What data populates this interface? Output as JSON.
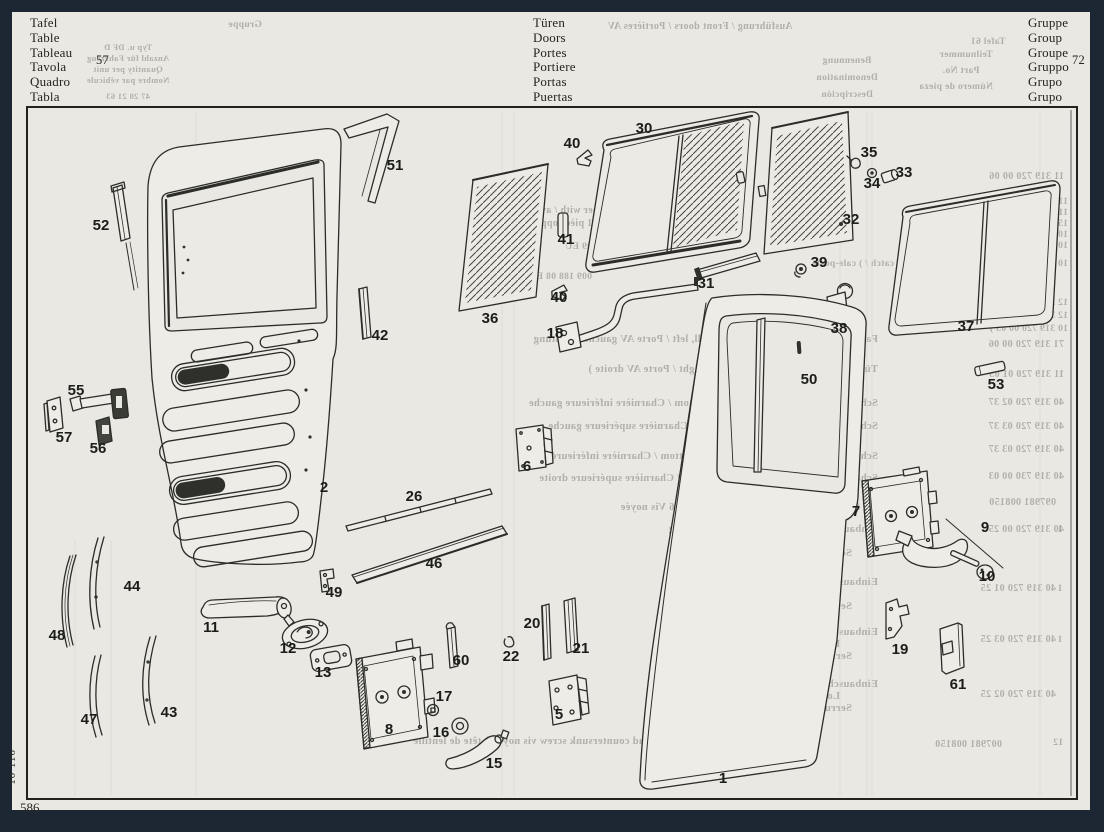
{
  "page": {
    "background": "#e9e8e3",
    "frame_color": "#1d2734"
  },
  "header": {
    "table_block": {
      "lines": [
        "Tafel",
        "Table",
        "Tableau",
        "Tavola",
        "Quadro",
        "Tabla"
      ],
      "number": "57"
    },
    "title_block": {
      "lines": [
        "Türen",
        "Doors",
        "Portes",
        "Portiere",
        "Portas",
        "Puertas"
      ]
    },
    "group_block": {
      "lines": [
        "Gruppe",
        "Group",
        "Groupe",
        "Gruppo",
        "Grupo",
        "Grupo"
      ],
      "number": "72"
    }
  },
  "footer": {
    "plate_number": "586",
    "margin_code": "10 116"
  },
  "diagram": {
    "part_labels": [
      {
        "t": "1",
        "x": 723,
        "y": 783
      },
      {
        "t": "2",
        "x": 324,
        "y": 492
      },
      {
        "t": "5",
        "x": 559,
        "y": 719
      },
      {
        "t": "6",
        "x": 527,
        "y": 471
      },
      {
        "t": "7",
        "x": 856,
        "y": 516
      },
      {
        "t": "8",
        "x": 389,
        "y": 734
      },
      {
        "t": "9",
        "x": 985,
        "y": 532
      },
      {
        "t": "10",
        "x": 987,
        "y": 581
      },
      {
        "t": "11",
        "x": 211,
        "y": 632
      },
      {
        "t": "12",
        "x": 288,
        "y": 653
      },
      {
        "t": "13",
        "x": 323,
        "y": 677
      },
      {
        "t": "15",
        "x": 494,
        "y": 768
      },
      {
        "t": "16",
        "x": 441,
        "y": 737
      },
      {
        "t": "17",
        "x": 444,
        "y": 701
      },
      {
        "t": "18",
        "x": 555,
        "y": 338
      },
      {
        "t": "19",
        "x": 900,
        "y": 654
      },
      {
        "t": "20",
        "x": 532,
        "y": 628
      },
      {
        "t": "21",
        "x": 581,
        "y": 653
      },
      {
        "t": "22",
        "x": 511,
        "y": 661
      },
      {
        "t": "26",
        "x": 414,
        "y": 501
      },
      {
        "t": "30",
        "x": 644,
        "y": 133
      },
      {
        "t": "31",
        "x": 706,
        "y": 288
      },
      {
        "t": "32",
        "x": 851,
        "y": 224
      },
      {
        "t": "33",
        "x": 904,
        "y": 177
      },
      {
        "t": "34",
        "x": 872,
        "y": 188
      },
      {
        "t": "35",
        "x": 869,
        "y": 157
      },
      {
        "t": "36",
        "x": 490,
        "y": 323
      },
      {
        "t": "37",
        "x": 966,
        "y": 331
      },
      {
        "t": "38",
        "x": 839,
        "y": 333
      },
      {
        "t": "39",
        "x": 819,
        "y": 267
      },
      {
        "t": "40",
        "x": 572,
        "y": 148
      },
      {
        "t": "40",
        "x": 559,
        "y": 302
      },
      {
        "t": "41",
        "x": 566,
        "y": 244
      },
      {
        "t": "42",
        "x": 380,
        "y": 340
      },
      {
        "t": "43",
        "x": 169,
        "y": 717
      },
      {
        "t": "44",
        "x": 132,
        "y": 591
      },
      {
        "t": "46",
        "x": 434,
        "y": 568
      },
      {
        "t": "47",
        "x": 89,
        "y": 724
      },
      {
        "t": "48",
        "x": 57,
        "y": 640
      },
      {
        "t": "49",
        "x": 334,
        "y": 597
      },
      {
        "t": "50",
        "x": 809,
        "y": 384
      },
      {
        "t": "51",
        "x": 395,
        "y": 170
      },
      {
        "t": "52",
        "x": 101,
        "y": 230
      },
      {
        "t": "53",
        "x": 996,
        "y": 389
      },
      {
        "t": "55",
        "x": 76,
        "y": 395
      },
      {
        "t": "56",
        "x": 98,
        "y": 453
      },
      {
        "t": "57",
        "x": 64,
        "y": 442
      },
      {
        "t": "60",
        "x": 461,
        "y": 665
      },
      {
        "t": "61",
        "x": 958,
        "y": 689
      }
    ],
    "bleedthrough": [
      {
        "t": "Ausführung / Front doors / Portières AV",
        "x": 700,
        "y": 29,
        "s": 10
      },
      {
        "t": "Gruppe",
        "x": 245,
        "y": 27,
        "s": 9.5
      },
      {
        "t": "Typ u. DF D",
        "x": 128,
        "y": 50,
        "s": 8.5
      },
      {
        "t": "Anzahl für Fahrzeug",
        "x": 128,
        "y": 61,
        "s": 8.5
      },
      {
        "t": "Quantity per unit",
        "x": 128,
        "y": 72,
        "s": 8.5
      },
      {
        "t": "Nombre par véhicule",
        "x": 128,
        "y": 83,
        "s": 8.5
      },
      {
        "t": "47   20   21   63",
        "x": 128,
        "y": 99,
        "s": 8.5
      },
      {
        "t": "Benennung",
        "x": 847,
        "y": 63,
        "s": 9.5
      },
      {
        "t": "Denomination",
        "x": 847,
        "y": 80,
        "s": 9.5
      },
      {
        "t": "Descripción",
        "x": 847,
        "y": 97,
        "s": 9.5
      },
      {
        "t": "Tafel  61",
        "x": 988,
        "y": 44,
        "s": 9.5
      },
      {
        "t": "Teilnummer",
        "x": 966,
        "y": 57,
        "s": 9.5
      },
      {
        "t": "Part No.",
        "x": 961,
        "y": 73,
        "s": 9.5
      },
      {
        "t": "Número de pieza",
        "x": 956,
        "y": 89,
        "s": 9.5
      },
      {
        "t": "11 319 720 00 06",
        "x": 1064,
        "y": 179,
        "s": 10,
        "a": "s"
      },
      {
        "t": "11 319 720 00 01  )",
        "x": 1068,
        "y": 204,
        "s": 9.5,
        "a": "s"
      },
      {
        "t": "11 312 720 00 01  )",
        "x": 1068,
        "y": 215,
        "s": 9.5,
        "a": "s"
      },
      {
        "t": "15 319 720 00 03  )",
        "x": 1068,
        "y": 226,
        "s": 9.5,
        "a": "s"
      },
      {
        "t": "10 319 720 01 03  )",
        "x": 1068,
        "y": 237,
        "s": 9.5,
        "a": "s"
      },
      {
        "t": "10 319 720 02 03  )",
        "x": 1068,
        "y": 248,
        "s": 9.5,
        "a": "s"
      },
      {
        "t": "zusammen mit / together with / avec  }",
        "x": 697,
        "y": 213,
        "s": 10,
        "a": "s"
      },
      {
        "t": "Gegenstück / 1 mating piece / 1 pièce opposée de",
        "x": 730,
        "y": 226,
        "s": 10,
        "a": "s"
      },
      {
        "t": "009 990 09 EU",
        "x": 628,
        "y": 249,
        "s": 9.5,
        "a": "s"
      },
      {
        "t": "10 319 720 01 43  )  1 Türfeststeller door catch /  ) cale-porte",
        "x": 1068,
        "y": 266,
        "s": 9.5,
        "a": "s"
      },
      {
        "t": "replaced by",
        "x": 1040,
        "y": 278,
        "s": 9.5,
        "a": "s"
      },
      {
        "t": "remplacé par",
        "x": 1044,
        "y": 290,
        "s": 9.5,
        "a": "s"
      },
      {
        "t": "009 188 08 EU",
        "x": 592,
        "y": 279,
        "s": 9.5,
        "a": "s"
      },
      {
        "t": "12 319 720 01 03  )",
        "x": 1068,
        "y": 305,
        "s": 9.5,
        "a": "s"
      },
      {
        "t": "12 319 720 01 93  )",
        "x": 1068,
        "y": 318,
        "s": 9.5,
        "a": "s"
      },
      {
        "t": "10 319 720 00 03  )",
        "x": 1068,
        "y": 331,
        "s": 9.5,
        "a": "s"
      },
      {
        "t": "71 319 720 00 06",
        "x": 1064,
        "y": 347,
        "s": 10,
        "a": "s"
      },
      {
        "t": "11 319 720 01 05",
        "x": 1064,
        "y": 377,
        "s": 10,
        "a": "s"
      },
      {
        "t": "40 319 720 02 37",
        "x": 1064,
        "y": 405,
        "s": 10,
        "a": "s"
      },
      {
        "t": "40 319 720 03 37",
        "x": 1064,
        "y": 429,
        "s": 10,
        "a": "s"
      },
      {
        "t": "40 319 720 03 37",
        "x": 1064,
        "y": 452,
        "s": 10,
        "a": "s"
      },
      {
        "t": "40 319 730 00 03",
        "x": 1064,
        "y": 479,
        "s": 10,
        "a": "s"
      },
      {
        "t": "097981 008150",
        "x": 1056,
        "y": 505,
        "s": 10,
        "a": "s"
      },
      {
        "t": "40 319 720 00 25",
        "x": 1064,
        "y": 532,
        "s": 10,
        "a": "s"
      },
      {
        "t": "40 319 720 01 25",
        "x": 1056,
        "y": 591,
        "s": 10,
        "a": "s"
      },
      {
        "t": "40 319 720 03 25",
        "x": 1056,
        "y": 642,
        "s": 10,
        "a": "s"
      },
      {
        "t": "40 319 720 02 25",
        "x": 1056,
        "y": 697,
        "s": 10,
        "a": "s"
      },
      {
        "t": "007981 008150",
        "x": 1002,
        "y": 747,
        "s": 10,
        "a": "s"
      },
      {
        "t": "Fahrerhaustür links / Front door shell, left / Porte AV gauche  ) Achtung",
        "x": 878,
        "y": 342,
        "s": 10.5,
        "a": "s"
      },
      {
        "t": "Türrohbau rechts / front door shell, right / Porte AV droite  )",
        "x": 878,
        "y": 372,
        "s": 10.5,
        "a": "s"
      },
      {
        "t": "Scharnier links unten / Hinge, left, bottom / Charnière inférieure gauche",
        "x": 878,
        "y": 406,
        "s": 10.5,
        "a": "s"
      },
      {
        "t": "Scharnier links oben / Hinge, left, top / Charnière supérieure gauche",
        "x": 878,
        "y": 429,
        "s": 10.5,
        "a": "s"
      },
      {
        "t": "Scharnier rechts unten / Hinge, right, bottom / Charnière inférieure droite",
        "x": 878,
        "y": 459,
        "s": 10.5,
        "a": "s"
      },
      {
        "t": "Scharnier rechts oben / Hinge, right, top / Charnière supérieure droite",
        "x": 878,
        "y": 481,
        "s": 10.5,
        "a": "s"
      },
      {
        "t": "Senkschraube / Countersunk screw  M 6  Vis noyée",
        "x": 860,
        "y": 510,
        "s": 10.5,
        "a": "s"
      },
      {
        "t": "Einbauschloß links ohne Innenverriegelung",
        "x": 878,
        "y": 532,
        "s": 10.5,
        "a": "s"
      },
      {
        "t": "Lock, left, without inner lock",
        "x": 840,
        "y": 544,
        "s": 10.5,
        "a": "s"
      },
      {
        "t": "Serrure gauche sans condamnation",
        "x": 852,
        "y": 556,
        "s": 10.5,
        "a": "s"
      },
      {
        "t": "Einbauschloß rechts mit Innenverriegelung",
        "x": 878,
        "y": 585,
        "s": 10.5,
        "a": "s"
      },
      {
        "t": "Lock, right, with inner lock",
        "x": 840,
        "y": 597,
        "s": 10.5,
        "a": "s"
      },
      {
        "t": "Serrure droite avec condamnation",
        "x": 852,
        "y": 609,
        "s": 10.5,
        "a": "s"
      },
      {
        "t": "Einbauschloß links mit Innenverriegelung",
        "x": 878,
        "y": 635,
        "s": 10.5,
        "a": "s"
      },
      {
        "t": "Lock, left, with inner lock",
        "x": 840,
        "y": 647,
        "s": 10.5,
        "a": "s"
      },
      {
        "t": "Serrure gauche avec condamnation",
        "x": 852,
        "y": 659,
        "s": 10.5,
        "a": "s"
      },
      {
        "t": "Einbauschloß rechts ohne Innenverriegelung",
        "x": 878,
        "y": 687,
        "s": 10.5,
        "a": "s"
      },
      {
        "t": "Lock, right, without inner lock",
        "x": 840,
        "y": 699,
        "s": 10.5,
        "a": "s"
      },
      {
        "t": "Serrure droite sans condamnation",
        "x": 852,
        "y": 711,
        "s": 10.5,
        "a": "s"
      },
      {
        "t": "Linsen-Senkschraube / Lens-head countersunk screw  vis noyée à tête de lentille",
        "x": 795,
        "y": 744,
        "s": 10.5,
        "a": "s"
      },
      {
        "t": "3",
        "x": 719,
        "y": 347,
        "s": 9.5
      },
      {
        "t": "5",
        "x": 719,
        "y": 377,
        "s": 9.5
      },
      {
        "t": "3",
        "x": 719,
        "y": 405,
        "s": 9.5
      },
      {
        "t": "6",
        "x": 719,
        "y": 429,
        "s": 9.5
      },
      {
        "t": "7",
        "x": 719,
        "y": 452,
        "s": 9.5
      },
      {
        "t": "1",
        "x": 1060,
        "y": 532,
        "s": 9.5
      },
      {
        "t": "1",
        "x": 1060,
        "y": 591,
        "s": 9.5
      },
      {
        "t": "1",
        "x": 1060,
        "y": 642,
        "s": 9.5
      },
      {
        "t": "12",
        "x": 1058,
        "y": 745,
        "s": 9.5
      }
    ]
  }
}
